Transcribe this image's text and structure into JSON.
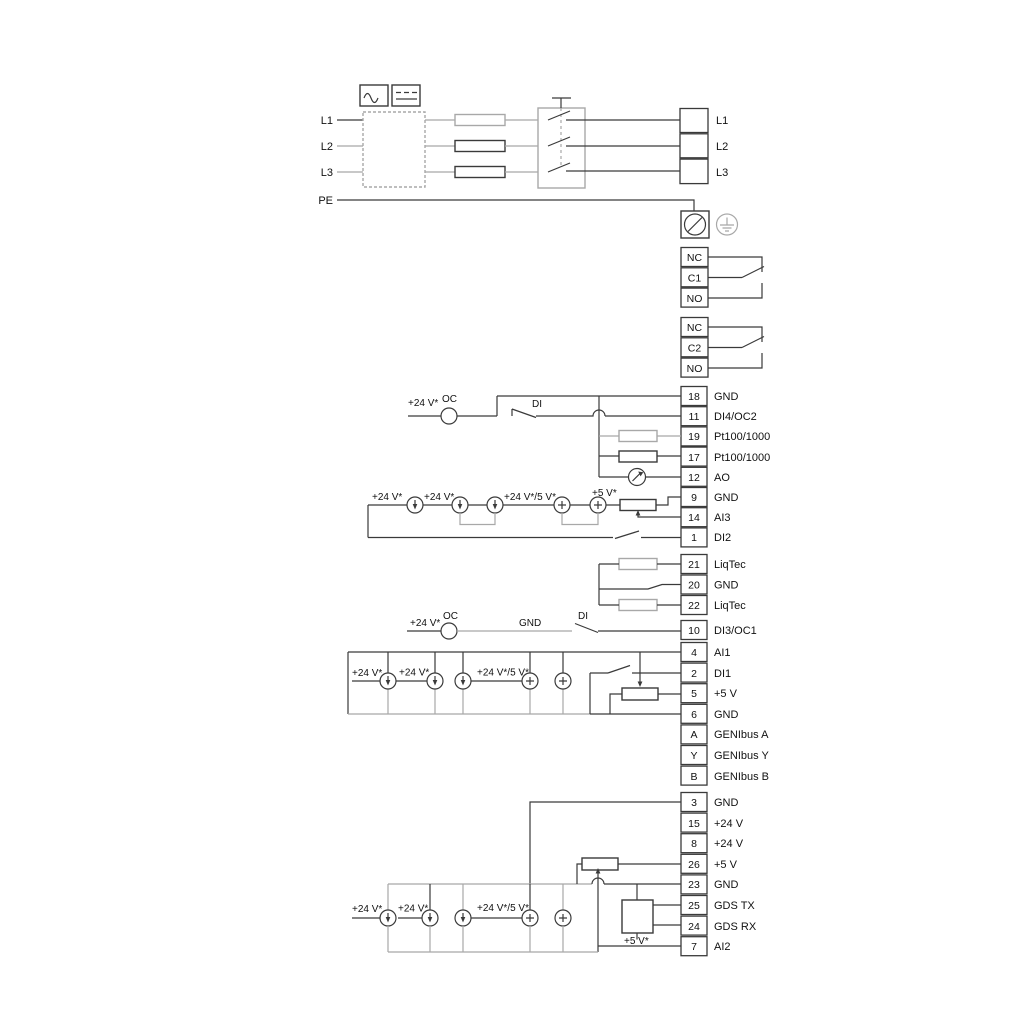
{
  "colors": {
    "wire": "#3a3a3a",
    "wire_light": "#a8a8a8",
    "text": "#111111",
    "background": "#ffffff"
  },
  "power": {
    "in": [
      "L1",
      "L2",
      "L3",
      "PE"
    ],
    "out": [
      "L1",
      "L2",
      "L3"
    ]
  },
  "relays": {
    "r1": [
      "NC",
      "C1",
      "NO"
    ],
    "r2": [
      "NC",
      "C2",
      "NO"
    ]
  },
  "t_io1": [
    {
      "n": "18",
      "l": "GND"
    },
    {
      "n": "11",
      "l": "DI4/OC2"
    },
    {
      "n": "19",
      "l": "Pt100/1000"
    },
    {
      "n": "17",
      "l": "Pt100/1000"
    },
    {
      "n": "12",
      "l": "AO"
    },
    {
      "n": "9",
      "l": "GND"
    },
    {
      "n": "14",
      "l": "AI3"
    },
    {
      "n": "1",
      "l": "DI2"
    }
  ],
  "t_liqtec": [
    {
      "n": "21",
      "l": "LiqTec"
    },
    {
      "n": "20",
      "l": "GND"
    },
    {
      "n": "22",
      "l": "LiqTec"
    }
  ],
  "t_di3": {
    "n": "10",
    "l": "DI3/OC1"
  },
  "t_io2": [
    {
      "n": "4",
      "l": "AI1"
    },
    {
      "n": "2",
      "l": "DI1"
    },
    {
      "n": "5",
      "l": "+5 V"
    },
    {
      "n": "6",
      "l": "GND"
    },
    {
      "n": "A",
      "l": "GENIbus A"
    },
    {
      "n": "Y",
      "l": "GENIbus Y"
    },
    {
      "n": "B",
      "l": "GENIbus B"
    }
  ],
  "t_io3": [
    {
      "n": "3",
      "l": "GND"
    },
    {
      "n": "15",
      "l": "+24 V"
    },
    {
      "n": "8",
      "l": "+24 V"
    },
    {
      "n": "26",
      "l": "+5 V"
    },
    {
      "n": "23",
      "l": "GND"
    },
    {
      "n": "25",
      "l": "GDS TX"
    },
    {
      "n": "24",
      "l": "GDS RX"
    },
    {
      "n": "7",
      "l": "AI2"
    }
  ],
  "ann": {
    "oc_top_supply": "+24 V*",
    "oc_top": "OC",
    "di_top": "DI",
    "ai3_s1": "+24 V*",
    "ai3_s2": "+24 V*",
    "ai3_s3": "+24 V*/5 V*",
    "ai3_s4": "+5 V*",
    "oc_mid_supply": "+24 V*",
    "oc_mid": "OC",
    "gnd_mid": "GND",
    "di_mid": "DI",
    "ai1_s1": "+24 V*",
    "ai1_s2": "+24 V*",
    "ai1_s3": "+24 V*/5 V*",
    "ai2_s1": "+24 V*",
    "ai2_s2": "+24 V*",
    "ai2_s3": "+24 V*/5 V*",
    "ai2_s4": "+5 V*"
  }
}
